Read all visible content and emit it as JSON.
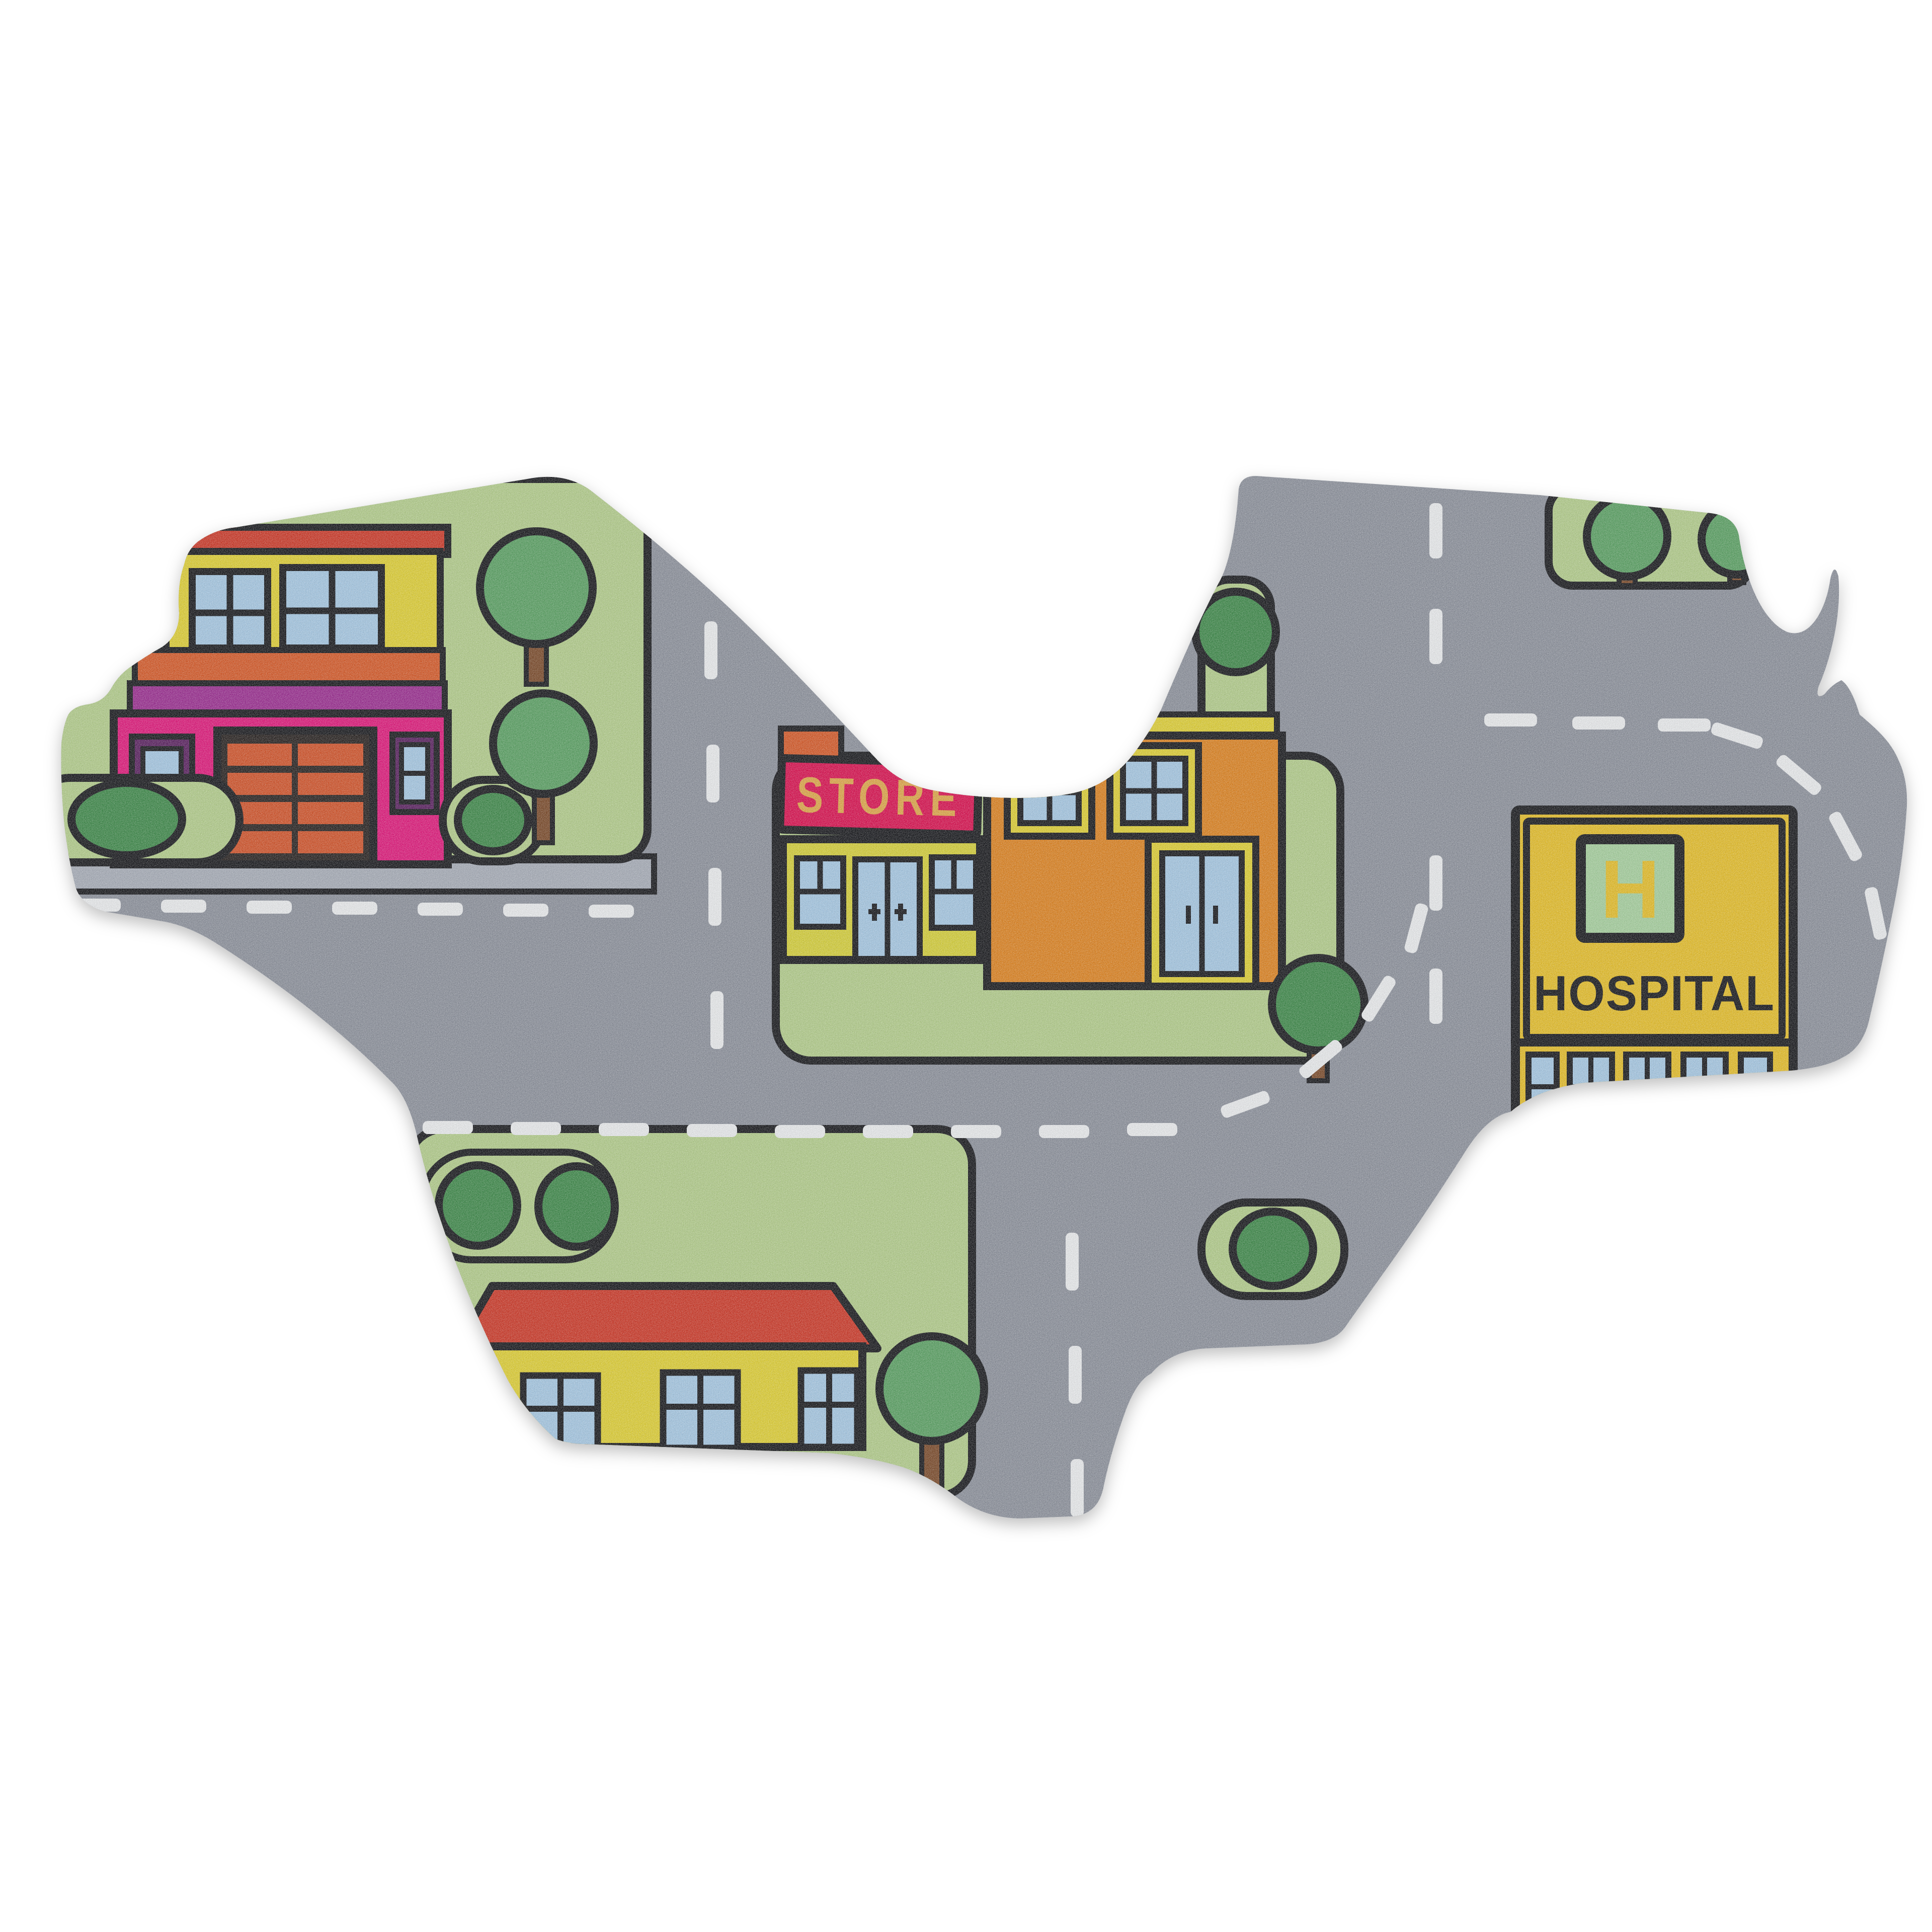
{
  "signs": {
    "store": "STORE",
    "hospital": "HOSPITAL",
    "hospital_symbol": "H"
  },
  "colors": {
    "background": "#ffffff",
    "outline": "#17181c",
    "road": "#8e939e",
    "road_light": "#a9afba",
    "road_marking": "#eef0f2",
    "lawn": "#b5d08d",
    "bush_dark": "#3f8b4b",
    "tree_green": "#5ba364",
    "trunk_brown": "#7c4b2a",
    "roof_red": "#cf3928",
    "house_pink": "#e2187c",
    "house_magenta": "#9c2d92",
    "band_orange": "#d85a28",
    "house_yellow": "#e2d235",
    "window_blue": "#a8cbe7",
    "window_frame_purple": "#5a2060",
    "garage_dark": "#27211f",
    "garage_brick": "#d4542a",
    "store_sign": "#dc1050",
    "store_text": "#e2a94a",
    "store_front": "#d8d23a",
    "orange_building": "#e08420",
    "hospital_yellow": "#e8c029",
    "hospital_square_green": "#a8d3a0",
    "text_dark": "#17181c"
  }
}
